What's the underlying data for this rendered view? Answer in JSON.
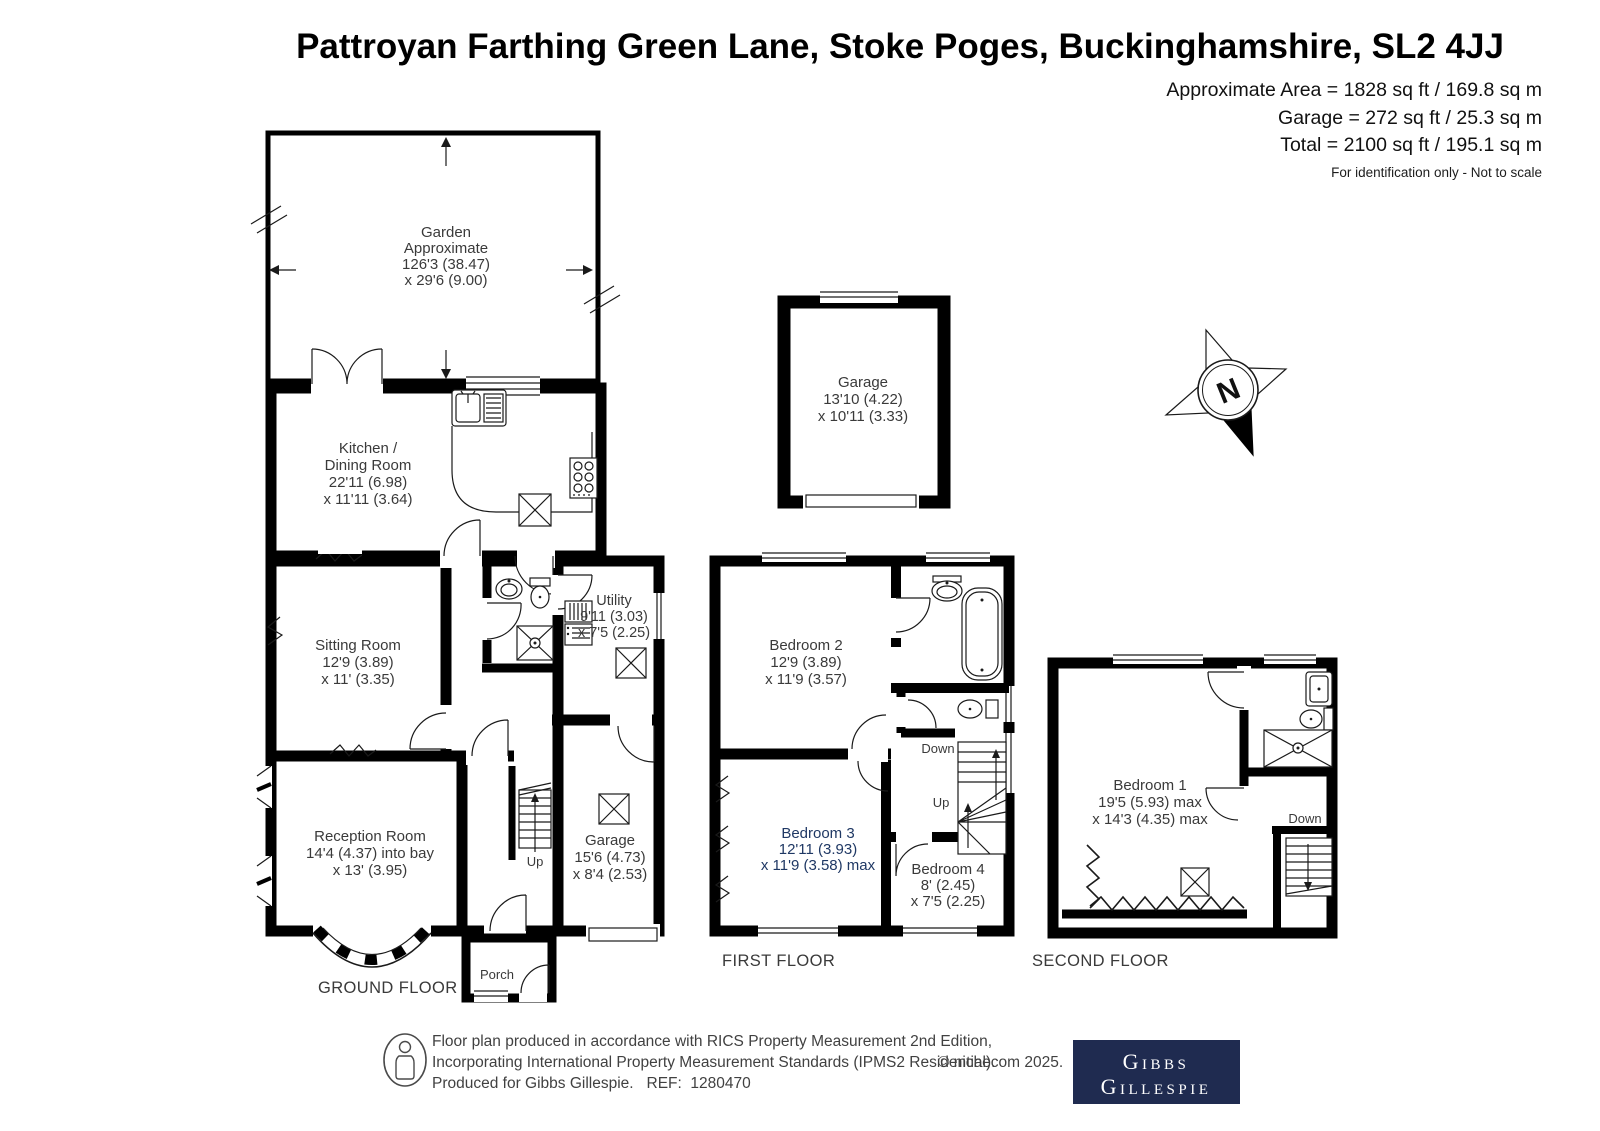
{
  "title": "Pattroyan Farthing Green Lane, Stoke Poges, Buckinghamshire, SL2 4JJ",
  "area": {
    "approx": "Approximate Area = 1828 sq ft / 169.8 sq m",
    "garage": "Garage = 272 sq ft / 25.3 sq m",
    "total": "Total = 2100 sq ft / 195.1 sq m",
    "disclaimer": "For identification only - Not to scale"
  },
  "colors": {
    "walls": "#000000",
    "label_text": "#3a3a3a",
    "bedroom3_text": "#1f3864",
    "logo_background": "#1f2b50"
  },
  "compass": {
    "north": "N"
  },
  "ground": {
    "label": "GROUND FLOOR",
    "garden": {
      "l1": "Garden",
      "l2": "Approximate",
      "l3": "126'3 (38.47)",
      "l4": "x 29'6 (9.00)"
    },
    "kitchen": {
      "l1": "Kitchen /",
      "l2": "Dining Room",
      "l3": "22'11 (6.98)",
      "l4": "x 11'11 (3.64)"
    },
    "sitting": {
      "l1": "Sitting Room",
      "l2": "12'9 (3.89)",
      "l3": "x 11' (3.35)"
    },
    "reception": {
      "l1": "Reception Room",
      "l2": "14'4 (4.37) into bay",
      "l3": "x 13' (3.95)"
    },
    "utility": {
      "l1": "Utility",
      "l2": "9'11 (3.03)",
      "l3": "x 7'5 (2.25)"
    },
    "garage": {
      "l1": "Garage",
      "l2": "15'6 (4.73)",
      "l3": "x 8'4 (2.53)"
    },
    "porch": "Porch",
    "up": "Up"
  },
  "outbuilding": {
    "garage": {
      "l1": "Garage",
      "l2": "13'10 (4.22)",
      "l3": "x 10'11 (3.33)"
    }
  },
  "first": {
    "label": "FIRST FLOOR",
    "bedroom2": {
      "l1": "Bedroom 2",
      "l2": "12'9 (3.89)",
      "l3": "x 11'9 (3.57)"
    },
    "bedroom3": {
      "l1": "Bedroom 3",
      "l2": "12'11 (3.93)",
      "l3": "x 11'9 (3.58) max"
    },
    "bedroom4": {
      "l1": "Bedroom 4",
      "l2": "8' (2.45)",
      "l3": "x 7'5 (2.25)"
    },
    "down": "Down",
    "up": "Up"
  },
  "second": {
    "label": "SECOND FLOOR",
    "bedroom1": {
      "l1": "Bedroom 1",
      "l2": "19'5 (5.93) max",
      "l3": "x 14'3 (4.35) max"
    },
    "down": "Down"
  },
  "footer": {
    "line1": "Floor plan produced in accordance with RICS Property Measurement 2nd Edition,",
    "line2": "Incorporating International Property Measurement Standards (IPMS2 Residential).",
    "copyright": "© nichecom 2025.",
    "line3": "Produced for Gibbs Gillespie.   REF:  1280470",
    "logo1": "Gibbs",
    "logo2": "Gillespie"
  }
}
